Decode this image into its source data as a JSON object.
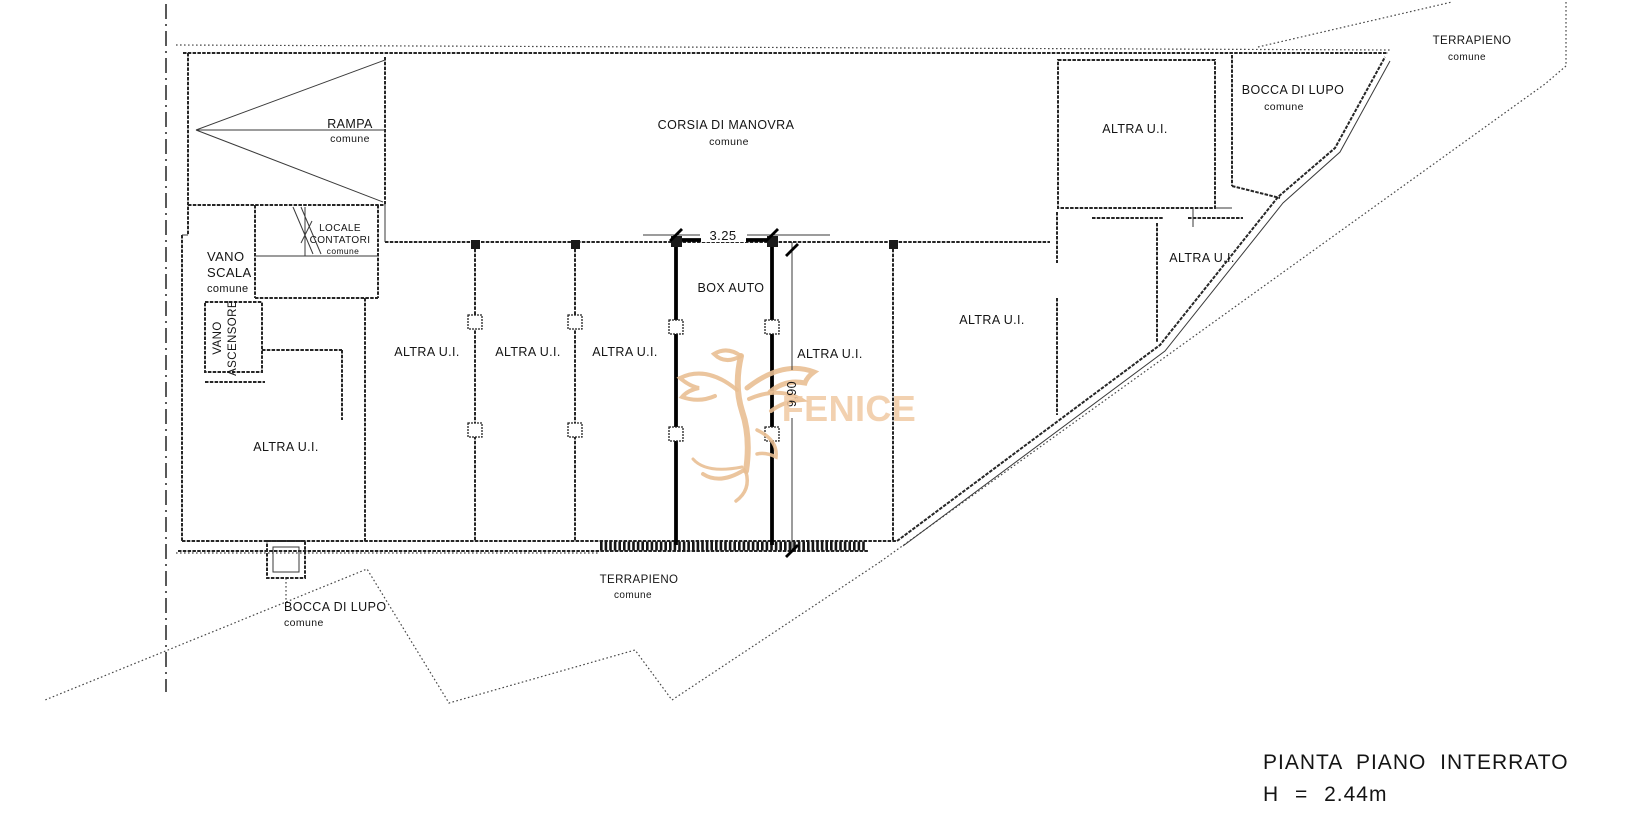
{
  "drawing": {
    "title_line1": "PIANTA PIANO INTERRATO",
    "title_line2": "H = 2.44m"
  },
  "watermark": {
    "text": "FENICE",
    "color": "#eec19a"
  },
  "dims": {
    "box_width": "3.25",
    "box_depth": "9,90"
  },
  "rooms": {
    "rampa": [
      "RAMPA",
      "comune"
    ],
    "corsia": [
      "CORSIA DI MANOVRA",
      "comune"
    ],
    "vano_scala": [
      "VANO",
      "SCALA",
      "comune"
    ],
    "locale_contatori": [
      "LOCALE",
      "CONTATORI",
      "comune"
    ],
    "vano_ascensore": [
      "VANO",
      "ASCENSORE"
    ],
    "altra_ui": "ALTRA U.I.",
    "box_auto": "BOX AUTO",
    "bocca_di_lupo": [
      "BOCCA DI LUPO",
      "comune"
    ],
    "terrapieno": [
      "TERRAPIENO",
      "comune"
    ]
  }
}
